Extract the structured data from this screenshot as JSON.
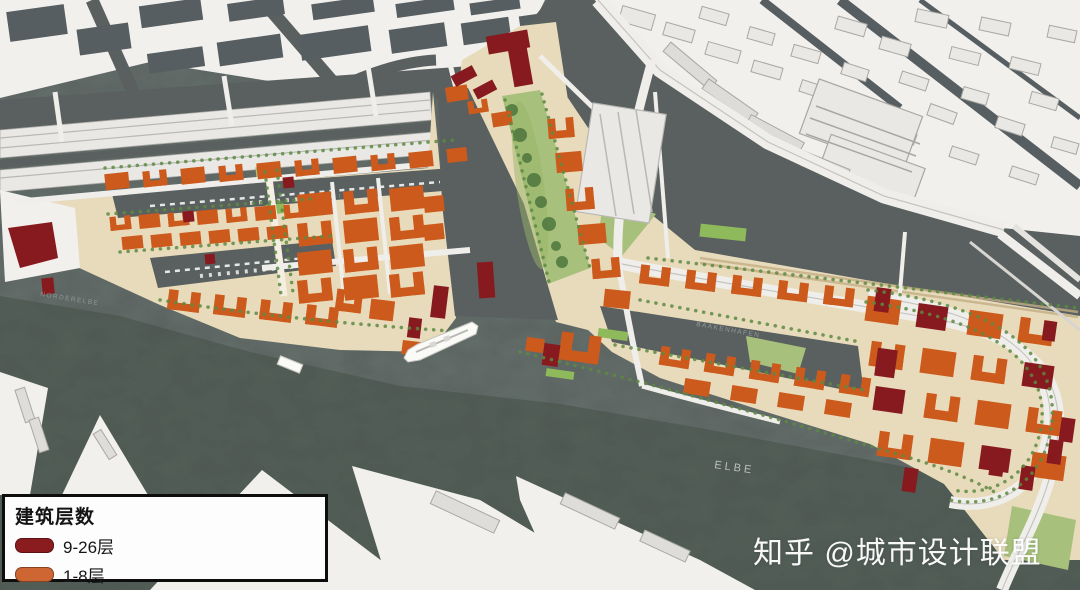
{
  "legend": {
    "title": "建筑层数",
    "items": [
      {
        "label": "9-26层",
        "color": "#8a1c20"
      },
      {
        "label": "1-8层",
        "color": "#cd6633"
      }
    ]
  },
  "watermark": {
    "text": "知乎 @城市设计联盟"
  },
  "water_labels": {
    "elbe": "ELBE",
    "baakenhafen": "BAAKENHAFEN",
    "norderelbe": "NORDERELBE"
  },
  "palette": {
    "water": "#59605f",
    "water_deep": "#3e4a41",
    "city_land": "#f1f0ed",
    "block_dark": "#575e61",
    "block_light": "#e9e8e5",
    "block_stroke": "#a8a7a3",
    "plan_land": "#e8dbbb",
    "plan_light": "#f1ead9",
    "orange": "#cd5a1d",
    "dark_red": "#871a1e",
    "park": "#a7c07b",
    "lawn": "#8fba5c",
    "tree": "#5d8a42",
    "tree_dark": "#47703a",
    "road": "#efeeea",
    "road_line": "#c4c3bf",
    "rail_tan": "#c3ae84",
    "ship": "#fafaf7",
    "speicher_line": "#b9b8b3"
  }
}
